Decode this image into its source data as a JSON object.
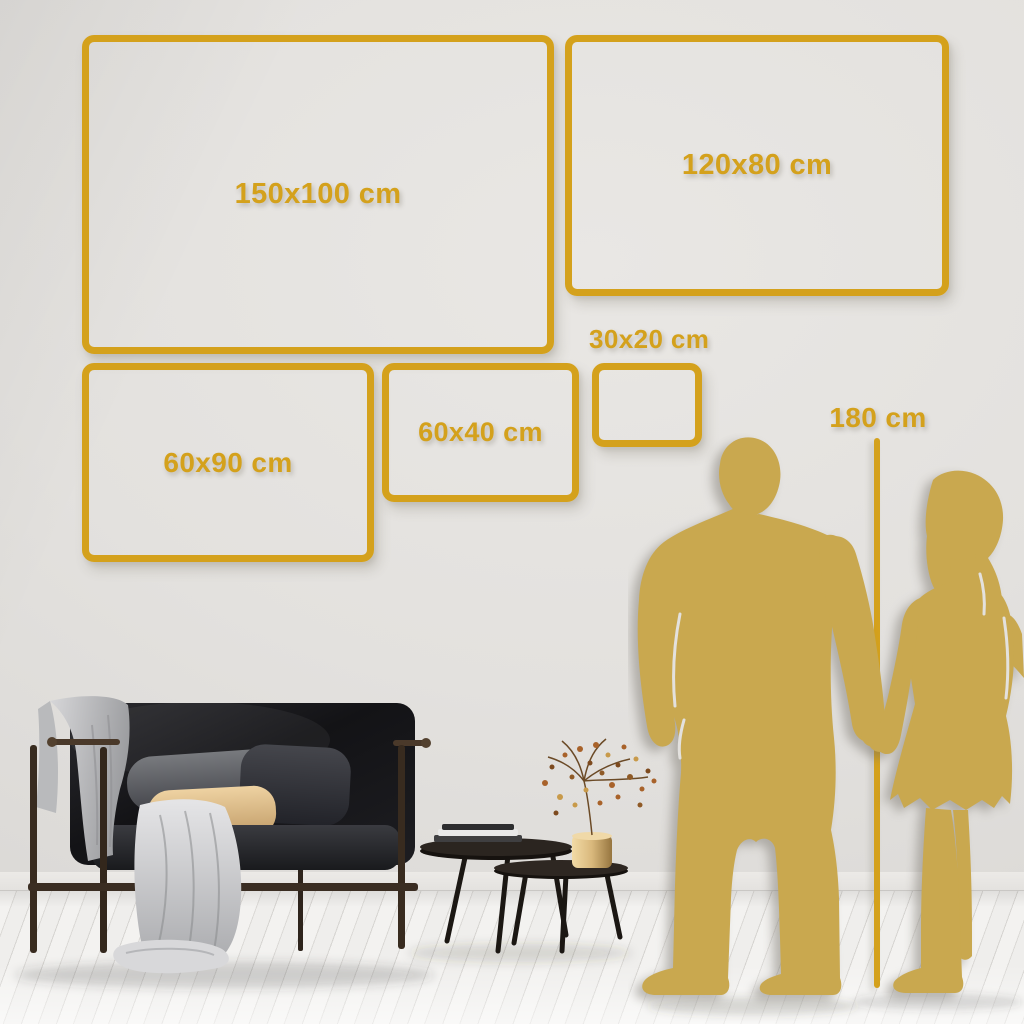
{
  "sizes": [
    {
      "id": "150x100",
      "label": "150x100 cm"
    },
    {
      "id": "120x80",
      "label": "120x80 cm"
    },
    {
      "id": "60x90",
      "label": "60x90 cm"
    },
    {
      "id": "60x40",
      "label": "60x40 cm"
    },
    {
      "id": "30x20",
      "label": "30x20 cm"
    }
  ],
  "height_reference": {
    "label": "180 cm"
  },
  "colors": {
    "gold": "#D4A11C",
    "silhouette": "#C9A84F",
    "wall": "#E2E0DD",
    "floor": "#F2F1EF"
  }
}
